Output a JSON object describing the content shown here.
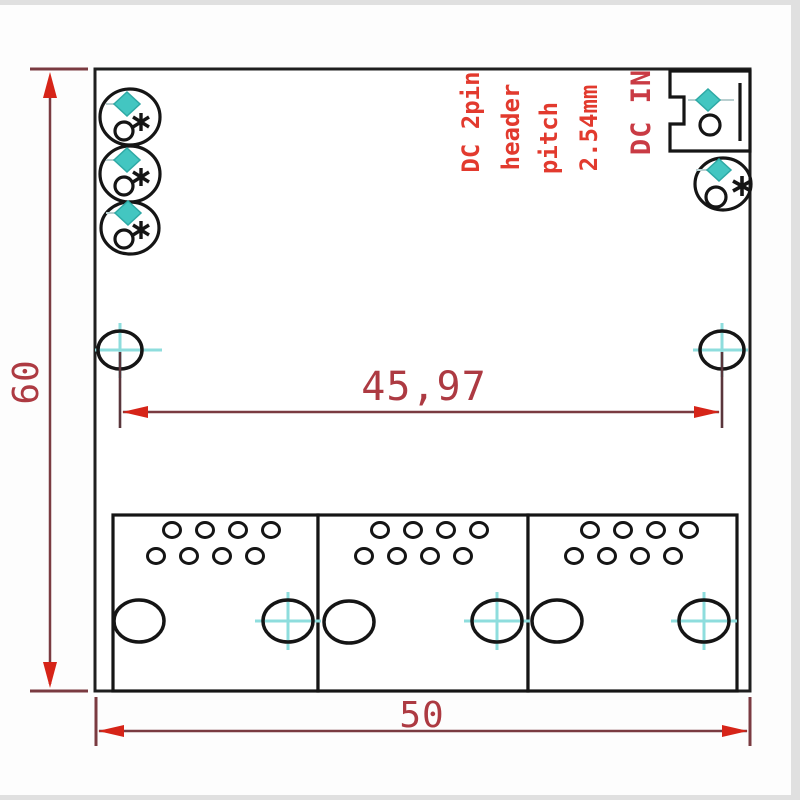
{
  "drawing": {
    "title": "PCB switch module dimension drawing",
    "dimensions": {
      "board_height_mm": "60",
      "hole_spacing_mm": "45,97",
      "board_width_mm": "50"
    },
    "annotations": {
      "header_note_lines": [
        "DC 2pin",
        "header",
        "pitch",
        "2.54mm"
      ],
      "dc_in_label": "DC IN"
    },
    "colors": {
      "board_outline": "#1f1f1f",
      "connector_outline": "#151515",
      "dimension_line": "#7a3b41",
      "extension_line": "#5a363c",
      "dimension_text": "#ad3a42",
      "arrow_red": "#d62418",
      "note_text": "#e23a2e",
      "dc_in_text": "#c93b44",
      "pad_teal": "#43c6c1",
      "pad_leader_gray": "#b9cfd0",
      "crosshair_cyan": "#8edddd",
      "photo_edge": "#e0e0e0"
    },
    "icons": {
      "positive_pad": "teal-diamond-pad-icon",
      "negative_pad": "round-pad-icon",
      "polarity_mark": "asterisk-icon",
      "mounting_hole": "crosshair-target-icon"
    }
  }
}
